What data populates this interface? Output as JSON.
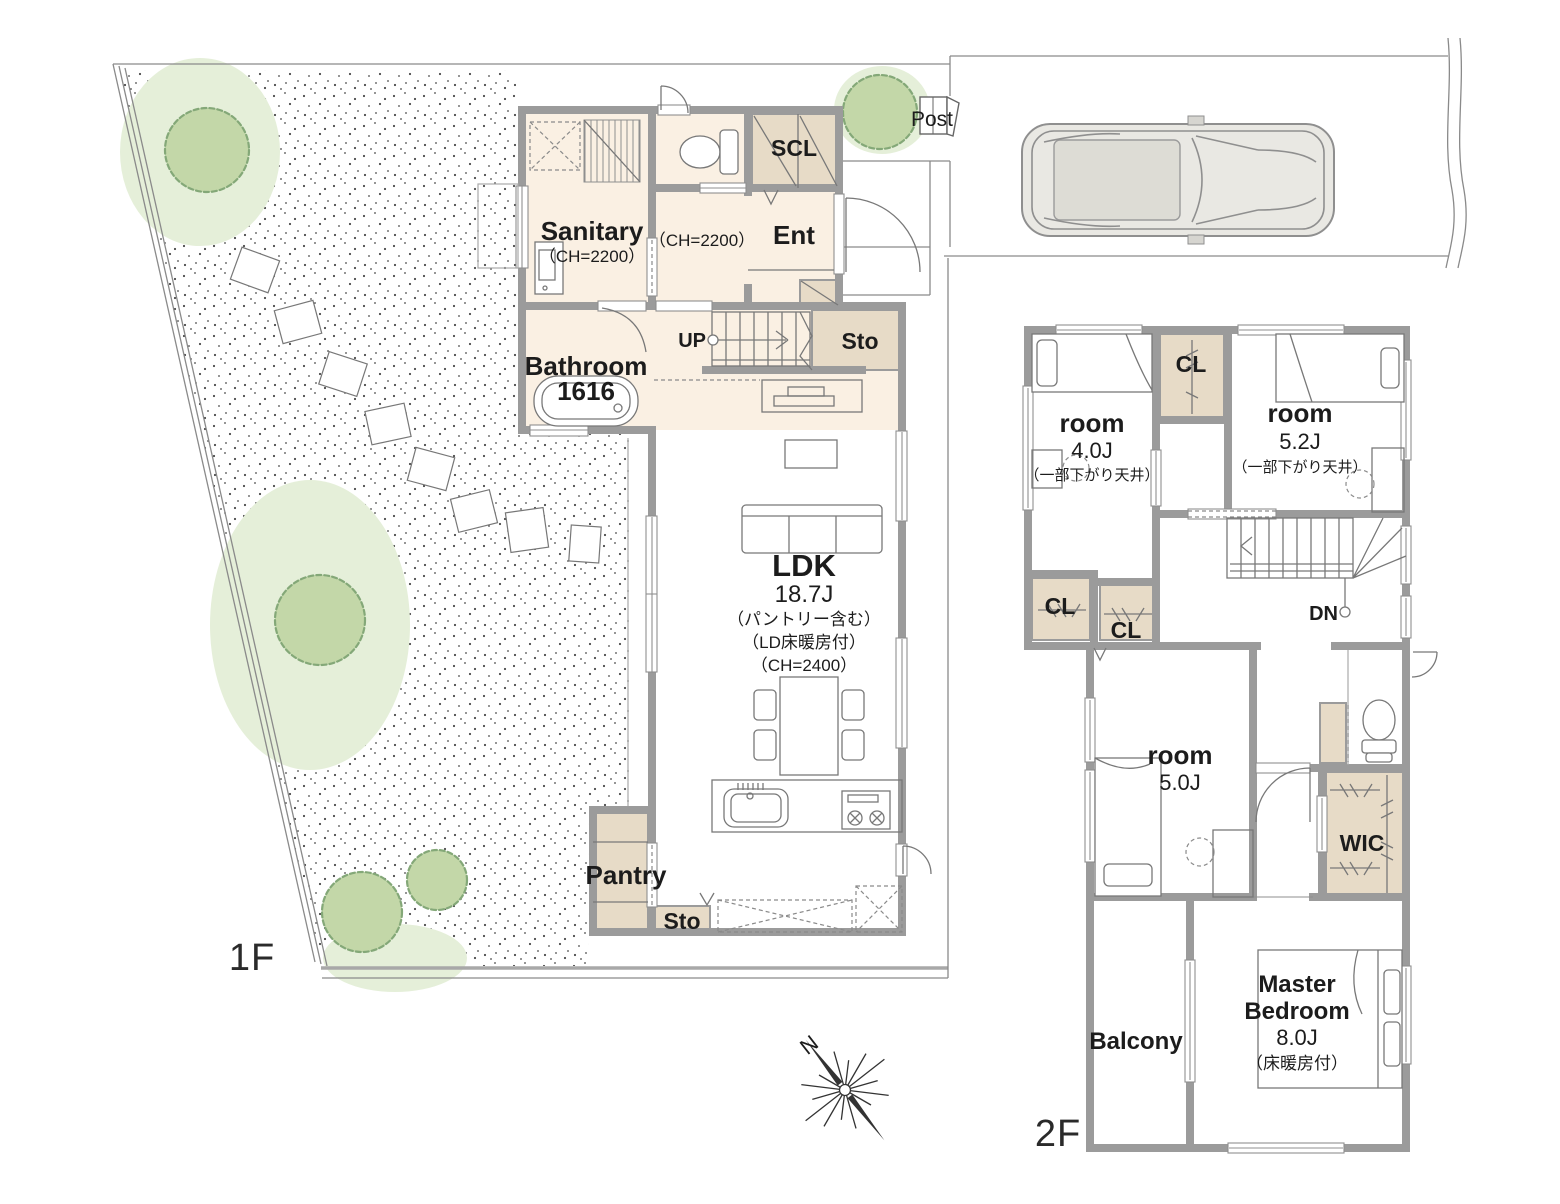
{
  "site": {
    "post_label": "Post",
    "floor1_label": "1F",
    "floor2_label": "2F"
  },
  "compass": {
    "north_label": "N"
  },
  "floor1": {
    "sanitary_name": "Sanitary",
    "sanitary_note": "（CH=2200）",
    "hall_note": "（CH=2200）",
    "scl_label": "SCL",
    "ent_label": "Ent",
    "bathroom_name": "Bathroom",
    "bathroom_size": "1616",
    "stairs_up_label": "UP",
    "sto_stairs_label": "Sto",
    "ldk_name": "LDK",
    "ldk_size": "18.7J",
    "ldk_note1": "（パントリー含む）",
    "ldk_note2": "（LD床暖房付）",
    "ldk_note3": "（CH=2400）",
    "pantry_label": "Pantry",
    "sto_kitchen_label": "Sto"
  },
  "floor2": {
    "room1_name": "room",
    "room1_size": "4.0J",
    "room1_note": "（一部下がり天井）",
    "cl_top_label": "CL",
    "room2_name": "room",
    "room2_size": "5.2J",
    "room2_note": "（一部下がり天井）",
    "cl_a_label": "CL",
    "cl_b_label": "CL",
    "stairs_down_label": "DN",
    "room3_name": "room",
    "room3_size": "5.0J",
    "wic_label": "WIC",
    "master_name_line1": "Master",
    "master_name_line2": "Bedroom",
    "master_size": "8.0J",
    "master_note": "（床暖房付）",
    "balcony_label": "Balcony"
  },
  "colors": {
    "wall_gray": "#9b9b9b",
    "floor_cream": "#faf0e3",
    "closet_beige": "#e7dbc7",
    "lawn_green": "#e5efd9",
    "tree_green": "#c3d7a8",
    "car_body": "#e9e8e3",
    "car_roof": "#dddcd5",
    "gravel_dot": "#4a4a4a"
  }
}
